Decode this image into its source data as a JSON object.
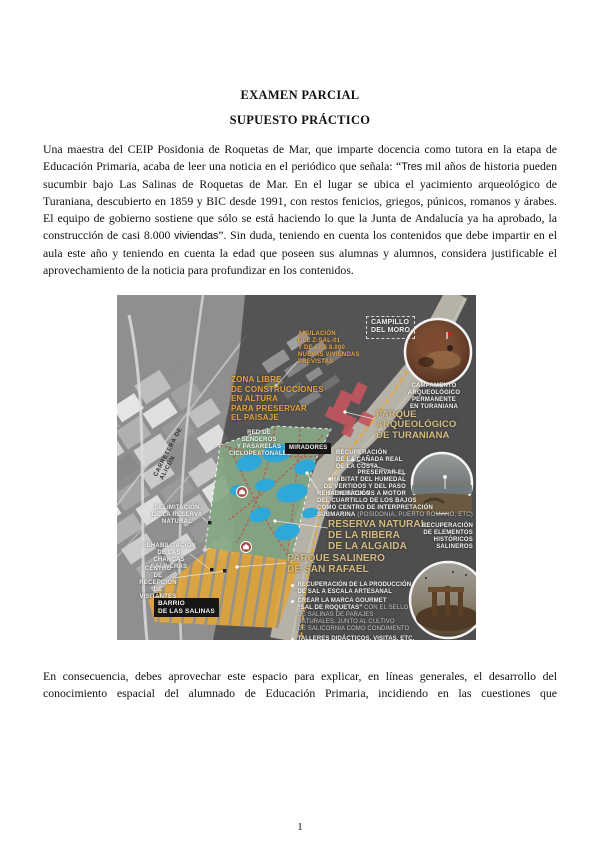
{
  "page": {
    "number": "1"
  },
  "titles": {
    "main": "EXAMEN PARCIAL",
    "subtitle": "SUPUESTO PRÁCTICO"
  },
  "paragraph1": {
    "part1": "Una maestra del CEIP Posidonia de Roquetas de Mar, que imparte docencia como tutora en la etapa de Educación Primaria, acaba de leer una noticia en el periódico que señala: “",
    "quote_word": "Tres",
    "part2": " mil años de historia pueden sucumbir bajo Las Salinas de Roquetas de Mar. En el lugar se ubica el yacimiento arqueológico de Turaniana, descubierto en 1859 y BIC desde 1991, con restos fenicios, griegos, púnicos, romanos y árabes. El equipo de gobierno sostiene que sólo se está haciendo lo que la Junta de Andalucía ya ha aprobado, la construcción de casi 8.000 ",
    "brand_word": "viviendas",
    "part3": "”. Sin duda, teniendo en cuenta los contenidos que debe impartir en el aula este año y teniendo en cuenta la edad que poseen sus alumnas y alumnos, considera justificable el aprovechamiento de la noticia para profundizar en los contenidos."
  },
  "paragraph2": "En consecuencia, debes aprovechar este espacio para explicar, en líneas generales, el desarrollo del conocimiento espacial del alumnado de Educación Primaria, incidiendo en las cuestiones que",
  "map": {
    "labels": {
      "anulacion": "ANULACIÓN\nDEL Z-SAL-01\nY DE LAS 8.000\nNUEVAS VIVIENDAS\nPREVISTAS",
      "campillo": "CAMPILLO\nDEL MORO",
      "zona_libre": "ZONA LIBRE\nDE CONSTRUCCIONES\nEN ALTURA\nPARA PRESERVAR\nEL PAISAJE",
      "campamento": "CAMPAMENTO\nARQUEOLÓGICO\nPERMANENTE\nEN TURANIANA",
      "parque_arqueologico": "PARQUE\nARQUEOLÓGICO\nDE TURANIANA",
      "red_senderos": "RED DE SENDEROS\nY PASARELAS\nCICLOPEATONALES",
      "miradores": "MIRADORES",
      "canada": "RECUPERACIÓN\nDE LA CAÑADA REAL\nDE LA COSTA",
      "preservar": "PRESERVAR EL\nHÁBITAT DEL HUMEDAL\nDE VERTIDOS Y DEL PASO\nDE VEHÍCULOS A MOTOR",
      "cuartillo_strong": "REHABILITACIÓN\nDEL CUARTILLO DE LOS BAJOS\nCOMO CENTRO DE INTERPRETACIÓN\nSUBMARINA",
      "cuartillo_dim": " (POSIDONIA, PUERTO ROMANO, ETC)",
      "reserva_natural": "RESERVA NATURAL\nDE LA RIBERA\nDE LA ALGAIDA",
      "recuperacion_elementos": "RECUPERACIÓN\nDE ELEMENTOS\nHISTÓRICOS\nSALINEROS",
      "parque_salinero": "PARQUE SALINERO\nDE SAN RAFAEL",
      "barrio": "BARRIO\nDE LAS SALINAS",
      "delimitacion": "DELIMITACIÓN\nDE LA RESERVA\nNATURAL",
      "charcas": "REHABILITACIÓN\nDE LAS CHARCAS\nSALINERAS",
      "centro_recepcion": "CENTRO\nDE RECEPCIÓN\nDE VISITANTES",
      "carretera": "CARRETERA DE ALICÚN"
    },
    "bullets": [
      {
        "strong": "RECUPERACIÓN DE LA PRODUCCIÓN\nDE SAL A ESCALA ARTESANAL",
        "dim": ""
      },
      {
        "strong": "CREAR LA MARCA GOURMET\n“SAL DE ROQUETAS”",
        "dim": " CON EL SELLO\nDE SALINAS DE PARAJES\nNATURALES, JUNTO AL CULTIVO\nDE SALICORNIA COMO CONDIMENTO"
      },
      {
        "strong": "TALLERES DIDÁCTICOS, VISITAS, ETC.",
        "dim": ""
      }
    ],
    "colors": {
      "accent_orange": "#E8A33C",
      "dashed_route": "#E9A62A",
      "tan_title": "#D5BC82",
      "wetland_green": "#86A986",
      "pond_blue": "#2EA7D9",
      "salt_pan_orange": "#DEA53E",
      "trail_red": "#C0504D",
      "site_red": "#C4565E",
      "sea_gray": "#4E4E4E"
    }
  }
}
